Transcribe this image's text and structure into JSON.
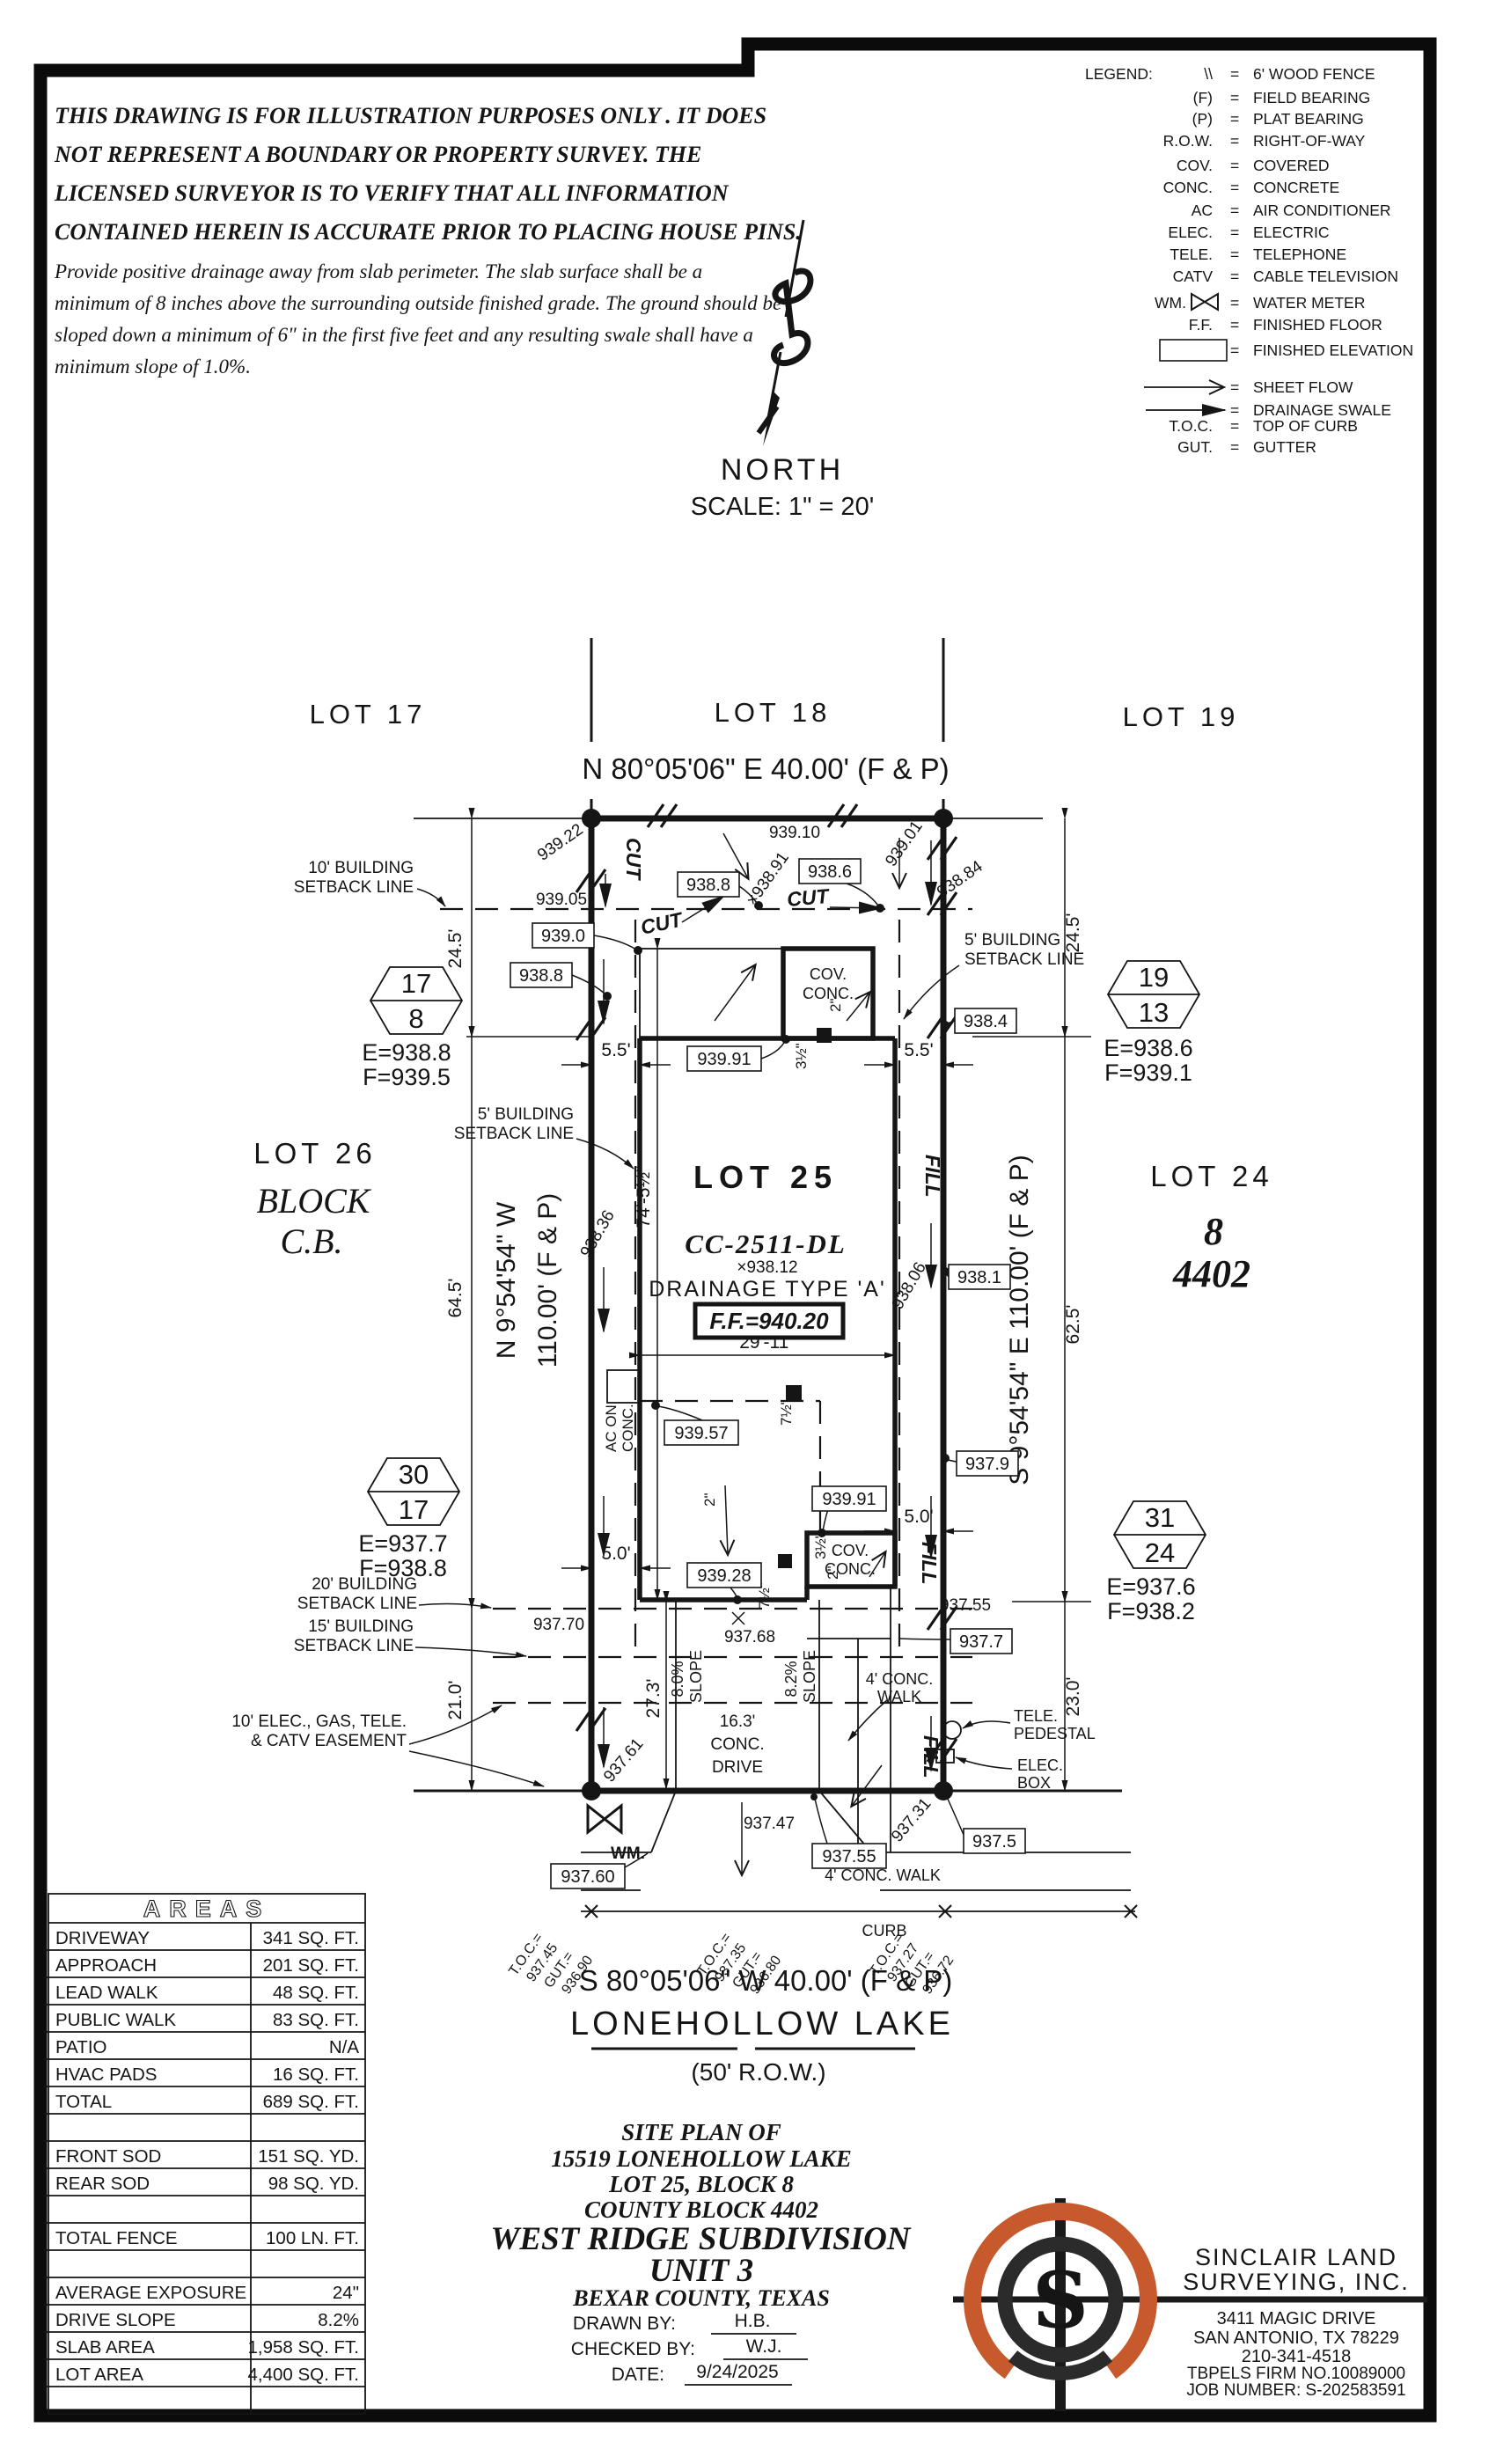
{
  "disclaimer": {
    "l1": "THIS DRAWING IS FOR ILLUSTRATION PURPOSES ONLY . IT DOES",
    "l2": "NOT REPRESENT A BOUNDARY OR PROPERTY SURVEY. THE",
    "l3": "LICENSED SURVEYOR IS TO VERIFY THAT ALL INFORMATION",
    "l4": "CONTAINED HEREIN IS ACCURATE PRIOR TO PLACING HOUSE PINS.",
    "l5": "Provide positive drainage away from slab perimeter. The slab surface shall be a",
    "l6": "minimum of 8 inches above the surrounding outside finished grade. The ground should be",
    "l7": "sloped down a minimum of 6\" in the first five feet and any resulting swale shall have a",
    "l8": "minimum slope of 1.0%."
  },
  "legend": {
    "title": "LEGEND:",
    "rows": [
      {
        "sym": "\\\\",
        "def": "6' WOOD FENCE"
      },
      {
        "sym": "(F)",
        "def": "FIELD BEARING"
      },
      {
        "sym": "(P)",
        "def": "PLAT BEARING"
      },
      {
        "sym": "R.O.W.",
        "def": "RIGHT-OF-WAY"
      },
      {
        "sym": "COV.",
        "def": "COVERED"
      },
      {
        "sym": "CONC.",
        "def": "CONCRETE"
      },
      {
        "sym": "AC",
        "def": "AIR CONDITIONER"
      },
      {
        "sym": "ELEC.",
        "def": "ELECTRIC"
      },
      {
        "sym": "TELE.",
        "def": "TELEPHONE"
      },
      {
        "sym": "CATV",
        "def": "CABLE TELEVISION"
      },
      {
        "sym": "WM.",
        "def": "WATER METER"
      },
      {
        "sym": "F.F.",
        "def": "FINISHED FLOOR"
      },
      {
        "sym": "000.00",
        "def": "FINISHED ELEVATION"
      },
      {
        "sym": "",
        "def": "SHEET FLOW"
      },
      {
        "sym": "",
        "def": "DRAINAGE SWALE"
      },
      {
        "sym": "T.O.C.",
        "def": "TOP OF CURB"
      },
      {
        "sym": "GUT.",
        "def": "GUTTER"
      }
    ],
    "eq": "="
  },
  "north": {
    "label": "NORTH",
    "scale": "SCALE: 1\" = 20'"
  },
  "plat": {
    "lots": {
      "lot17": "LOT 17",
      "lot18": "LOT 18",
      "lot19": "LOT 19",
      "lot25": "LOT 25",
      "lot26": "LOT 26",
      "lot24": "LOT 24",
      "block_word": "BLOCK",
      "cb": "C.B.",
      "blk8": "8",
      "cb4402": "4402"
    },
    "bearings": {
      "top": "N 80°05'06\" E 40.00' (F & P)",
      "bottom": "S 80°05'06\" W 40.00' (F & P)",
      "west1": "N 9°54'54\" W",
      "west2": "110.00' (F & P)",
      "east": "S 9°54'54\" E 110.00' (F & P)"
    },
    "street": {
      "name": "LONEHOLLOW LAKE",
      "row": "(50' R.O.W.)",
      "curb": "CURB",
      "walk": "4' CONC. WALK"
    },
    "setbacks": {
      "sb10a": "10' BUILDING",
      "sb10b": "SETBACK LINE",
      "sb5a": "5' BUILDING",
      "sb5b": "SETBACK LINE",
      "sb20a": "20' BUILDING",
      "sb20b": "SETBACK LINE",
      "sb15a": "15' BUILDING",
      "sb15b": "SETBACK LINE",
      "easeA": "10' ELEC., GAS, TELE.",
      "easeB": "& CATV EASEMENT"
    },
    "house": {
      "model": "CC-2511-DL",
      "spot": "×938.12",
      "drain": "DRAINAGE TYPE 'A'",
      "ff": "F.F.=940.20",
      "covA": "COV.",
      "covB": "CONC.",
      "acA": "AC ON",
      "acB": "CONC.",
      "driveA": "16.3'",
      "driveB": "CONC.",
      "driveC": "DRIVE",
      "walkA": "4' CONC.",
      "walkB": "WALK",
      "slope1": "8.0%",
      "slope2": "8.2%",
      "slopeW": "SLOPE",
      "in2": "2\"",
      "in3h": "3½\"",
      "in7h": "7½\""
    },
    "dims": {
      "d245": "24.5'",
      "d55": "5.5'",
      "d645": "64.5'",
      "d625": "62.5'",
      "d210": "21.0'",
      "d230": "23.0'",
      "d50": "5.0'",
      "d74": "74'-5½\"",
      "d2911": "29'-11\"",
      "d273": "27.3'"
    },
    "feat": {
      "wm": "WM.",
      "teleA": "TELE.",
      "teleB": "PEDESTAL",
      "elecA": "ELEC.",
      "elecB": "BOX"
    },
    "cut": "CUT",
    "fill": "FILL",
    "hex": [
      {
        "t": "17",
        "b": "8",
        "e": "E=938.8",
        "f": "F=939.5"
      },
      {
        "t": "19",
        "b": "13",
        "e": "E=938.6",
        "f": "F=939.1"
      },
      {
        "t": "30",
        "b": "17",
        "e": "E=937.7",
        "f": "F=938.8"
      },
      {
        "t": "31",
        "b": "24",
        "e": "E=937.6",
        "f": "F=938.2"
      }
    ],
    "ebox": [
      {
        "v": "939.0"
      },
      {
        "v": "938.8"
      },
      {
        "v": "938.8"
      },
      {
        "v": "938.6"
      },
      {
        "v": "938.4"
      },
      {
        "v": "938.1"
      },
      {
        "v": "937.9"
      },
      {
        "v": "937.7"
      },
      {
        "v": "939.57"
      },
      {
        "v": "939.91"
      },
      {
        "v": "939.91"
      },
      {
        "v": "939.28"
      },
      {
        "v": "937.55"
      },
      {
        "v": "937.5"
      },
      {
        "v": "937.60"
      }
    ],
    "spot": [
      {
        "v": "939.22"
      },
      {
        "v": "939.10"
      },
      {
        "v": "939.05"
      },
      {
        "v": "×938.91"
      },
      {
        "v": "939.01"
      },
      {
        "v": "938.84"
      },
      {
        "v": "938.36"
      },
      {
        "v": "938.06"
      },
      {
        "v": "937.70"
      },
      {
        "v": "937.55"
      },
      {
        "v": "937.68"
      },
      {
        "v": "937.61"
      },
      {
        "v": "937.47"
      },
      {
        "v": "937.31"
      }
    ],
    "toc": [
      {
        "t": "T.O.C.=",
        "tv": "937.45",
        "g": "GUT.=",
        "gv": "936.90"
      },
      {
        "t": "T.O.C.=",
        "tv": "937.35",
        "g": "GUT.=",
        "gv": "936.80"
      },
      {
        "t": "T.O.C.=",
        "tv": "937.27",
        "g": "GUT.=",
        "gv": "936.72"
      }
    ]
  },
  "areas": {
    "title": "AREAS",
    "rows": [
      {
        "label": "DRIVEWAY",
        "value": "341 SQ. FT."
      },
      {
        "label": "APPROACH",
        "value": "201 SQ. FT."
      },
      {
        "label": "LEAD WALK",
        "value": "48 SQ. FT."
      },
      {
        "label": "PUBLIC WALK",
        "value": "83 SQ. FT."
      },
      {
        "label": "PATIO",
        "value": "N/A"
      },
      {
        "label": "HVAC PADS",
        "value": "16 SQ. FT."
      },
      {
        "label": "TOTAL",
        "value": "689 SQ. FT."
      },
      {
        "label": "",
        "value": ""
      },
      {
        "label": "FRONT SOD",
        "value": "151 SQ. YD."
      },
      {
        "label": "REAR SOD",
        "value": "98 SQ. YD."
      },
      {
        "label": "",
        "value": ""
      },
      {
        "label": "TOTAL FENCE",
        "value": "100 LN. FT."
      },
      {
        "label": "",
        "value": ""
      },
      {
        "label": "AVERAGE EXPOSURE",
        "value": "24\""
      },
      {
        "label": "DRIVE SLOPE",
        "value": "8.2%"
      },
      {
        "label": "SLAB AREA",
        "value": "1,958 SQ. FT."
      },
      {
        "label": "LOT AREA",
        "value": "4,400 SQ. FT."
      },
      {
        "label": "",
        "value": ""
      }
    ]
  },
  "title_block": {
    "l1": "SITE PLAN OF",
    "l2": "15519 LONEHOLLOW LAKE",
    "l3": "LOT 25, BLOCK 8",
    "l4": "COUNTY BLOCK 4402",
    "l5": "WEST RIDGE SUBDIVISION",
    "l6": "UNIT 3",
    "l7": "BEXAR COUNTY, TEXAS",
    "drawn_label": "DRAWN BY:",
    "drawn_val": "H.B.",
    "checked_label": "CHECKED BY:",
    "checked_val": "W.J.",
    "date_label": "DATE:",
    "date_val": "9/24/2025"
  },
  "firm": {
    "name1": "SINCLAIR LAND",
    "name2": "SURVEYING, INC.",
    "addr1": "3411 MAGIC DRIVE",
    "addr2": "SAN ANTONIO, TX 78229",
    "phone": "210-341-4518",
    "tbpels": "TBPELS FIRM NO.10089000",
    "job": "JOB NUMBER: S-202583591",
    "logo_s": "S",
    "logo_orange": "#c65a2d"
  }
}
